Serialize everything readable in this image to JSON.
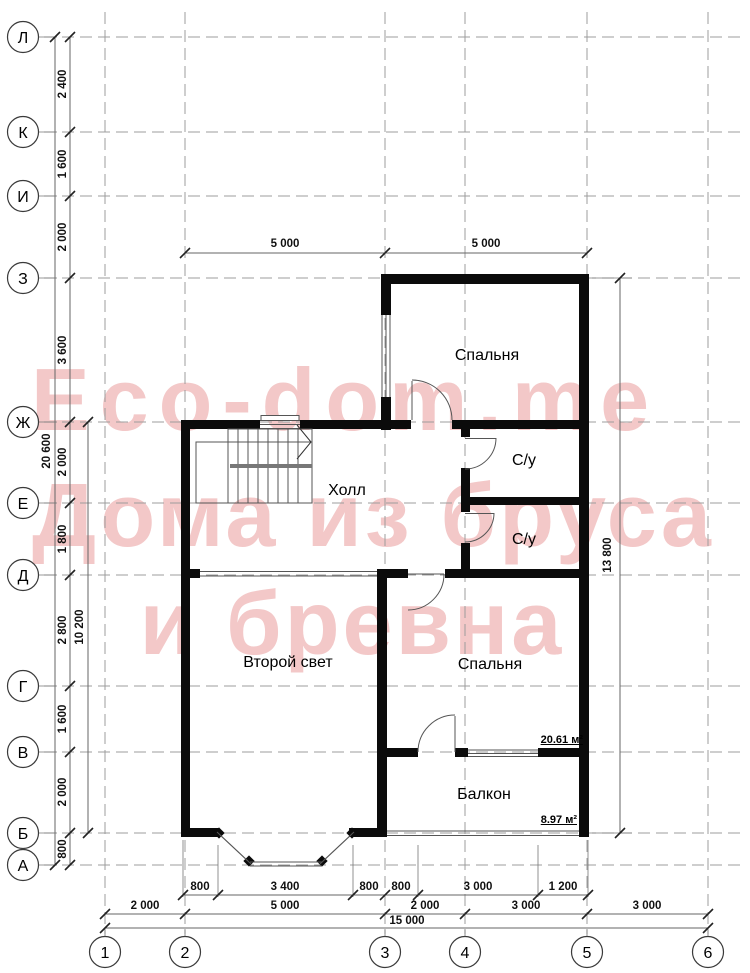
{
  "watermark": {
    "line1": "Eco-dom.me",
    "line2": "Дома из бруса",
    "line3": "и бревна",
    "color": "#f3c8c8"
  },
  "axes": {
    "rows": [
      "Л",
      "К",
      "И",
      "З",
      "Ж",
      "Е",
      "Д",
      "Г",
      "В",
      "Б",
      "А"
    ],
    "cols": [
      "1",
      "2",
      "3",
      "4",
      "5",
      "6"
    ]
  },
  "rooms": {
    "bedroom_top": "Спальня",
    "bathroom_top": "С/у",
    "bathroom_bottom": "С/у",
    "hall": "Холл",
    "second_light": "Второй свет",
    "bedroom_bottom": "Спальня",
    "balcony": "Балкон",
    "bedroom_bottom_area": "20.61 м²",
    "balcony_area": "8.97 м²"
  },
  "dims": {
    "left_overall": "20 600",
    "left_span": "10 200",
    "left": [
      "2 400",
      "1 600",
      "2 000",
      "3 600",
      "2 000",
      "1 800",
      "2 800",
      "1 600",
      "2 000",
      "800"
    ],
    "top": [
      "5 000",
      "5 000"
    ],
    "right": "13 800",
    "bottom_detail": [
      "800",
      "3 400",
      "800",
      "800",
      "3 000",
      "1 200"
    ],
    "bottom_mid": [
      "2 000",
      "5 000",
      "2 000",
      "3 000",
      "3 000"
    ],
    "bottom_overall": "15 000"
  },
  "colors": {
    "wall": "#0b0b0b",
    "grid": "#9c9c9c",
    "dimline": "#666666",
    "thin": "#555555"
  }
}
